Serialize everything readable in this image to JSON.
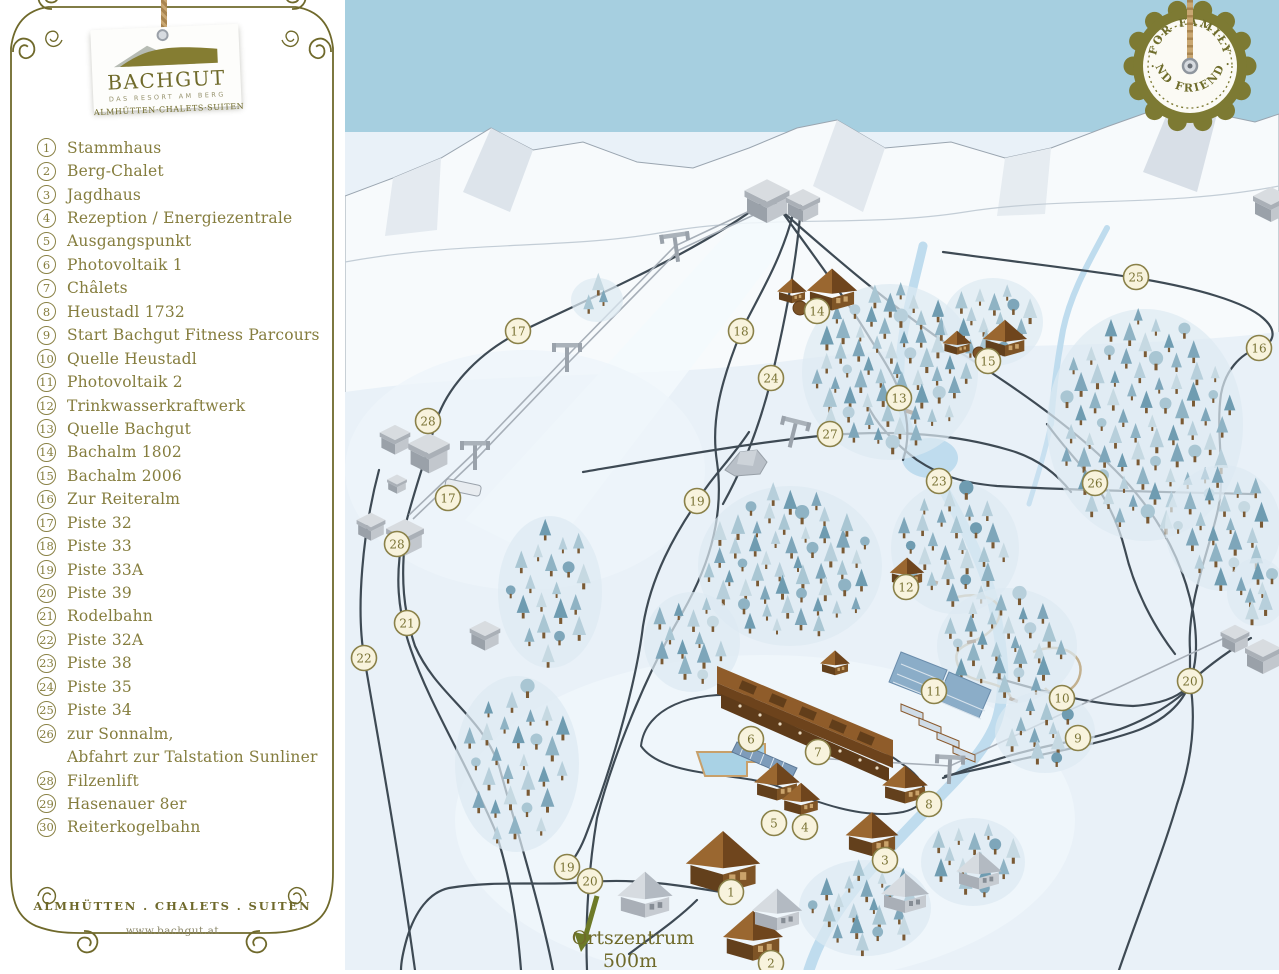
{
  "sidebar": {
    "logo": {
      "title": "BACHGUT",
      "subtitle": "DAS RESORT AM BERG",
      "tagline": "ALMHÜTTEN·CHALETS·SUITEN"
    },
    "legend": [
      {
        "num": "1",
        "label": "Stammhaus"
      },
      {
        "num": "2",
        "label": "Berg-Chalet"
      },
      {
        "num": "3",
        "label": "Jagdhaus"
      },
      {
        "num": "4",
        "label": "Rezeption / Energiezentrale"
      },
      {
        "num": "5",
        "label": "Ausgangspunkt"
      },
      {
        "num": "6",
        "label": "Photovoltaik 1"
      },
      {
        "num": "7",
        "label": "Châlets"
      },
      {
        "num": "8",
        "label": "Heustadl 1732"
      },
      {
        "num": "9",
        "label": "Start Bachgut Fitness Parcours"
      },
      {
        "num": "10",
        "label": "Quelle Heustadl"
      },
      {
        "num": "11",
        "label": "Photovoltaik 2"
      },
      {
        "num": "12",
        "label": "Trinkwasserkraftwerk"
      },
      {
        "num": "13",
        "label": "Quelle Bachgut"
      },
      {
        "num": "14",
        "label": "Bachalm 1802"
      },
      {
        "num": "15",
        "label": "Bachalm 2006"
      },
      {
        "num": "16",
        "label": "Zur Reiteralm"
      },
      {
        "num": "17",
        "label": "Piste 32"
      },
      {
        "num": "18",
        "label": "Piste 33"
      },
      {
        "num": "19",
        "label": "Piste 33A"
      },
      {
        "num": "20",
        "label": "Piste 39"
      },
      {
        "num": "21",
        "label": "Rodelbahn"
      },
      {
        "num": "22",
        "label": "Piste 32A"
      },
      {
        "num": "23",
        "label": "Piste 38"
      },
      {
        "num": "24",
        "label": "Piste 35"
      },
      {
        "num": "25",
        "label": "Piste 34"
      },
      {
        "num": "26",
        "label": "zur Sonnalm,",
        "label2": "Abfahrt zur Talstation Sunliner"
      },
      {
        "num": "28",
        "label": "Filzenlift"
      },
      {
        "num": "29",
        "label": "Hasenauer 8er"
      },
      {
        "num": "30",
        "label": "Reiterkogelbahn"
      }
    ],
    "footer": {
      "line1": "ALMHÜTTEN . CHALETS . SUITEN",
      "line2": "www.bachgut.at"
    }
  },
  "map": {
    "badge": {
      "top": "· FOR  FAMILY ·",
      "bottom": "· AND FRIENDS ·"
    },
    "direction_label": {
      "line1": "Ortszentrum",
      "line2": "500m"
    },
    "markers": [
      {
        "n": "17",
        "x": 173,
        "y": 331
      },
      {
        "n": "18",
        "x": 396,
        "y": 331
      },
      {
        "n": "14",
        "x": 472,
        "y": 311
      },
      {
        "n": "25",
        "x": 791,
        "y": 277
      },
      {
        "n": "16",
        "x": 914,
        "y": 348
      },
      {
        "n": "15",
        "x": 643,
        "y": 361
      },
      {
        "n": "24",
        "x": 426,
        "y": 378
      },
      {
        "n": "13",
        "x": 554,
        "y": 398
      },
      {
        "n": "28",
        "x": 83,
        "y": 421
      },
      {
        "n": "27",
        "x": 485,
        "y": 434
      },
      {
        "n": "23",
        "x": 594,
        "y": 481
      },
      {
        "n": "26",
        "x": 750,
        "y": 483
      },
      {
        "n": "19",
        "x": 352,
        "y": 501
      },
      {
        "n": "17",
        "x": 103,
        "y": 498
      },
      {
        "n": "28",
        "x": 52,
        "y": 544
      },
      {
        "n": "12",
        "x": 561,
        "y": 587
      },
      {
        "n": "21",
        "x": 62,
        "y": 623
      },
      {
        "n": "22",
        "x": 19,
        "y": 658
      },
      {
        "n": "20",
        "x": 845,
        "y": 681
      },
      {
        "n": "11",
        "x": 589,
        "y": 691
      },
      {
        "n": "10",
        "x": 717,
        "y": 698
      },
      {
        "n": "9",
        "x": 733,
        "y": 738
      },
      {
        "n": "6",
        "x": 406,
        "y": 739
      },
      {
        "n": "7",
        "x": 473,
        "y": 752
      },
      {
        "n": "8",
        "x": 584,
        "y": 804
      },
      {
        "n": "5",
        "x": 429,
        "y": 823
      },
      {
        "n": "4",
        "x": 460,
        "y": 827
      },
      {
        "n": "3",
        "x": 540,
        "y": 860
      },
      {
        "n": "19",
        "x": 222,
        "y": 867
      },
      {
        "n": "20",
        "x": 245,
        "y": 881
      },
      {
        "n": "1",
        "x": 386,
        "y": 892
      },
      {
        "n": "2",
        "x": 426,
        "y": 963
      }
    ],
    "tree_clusters": [
      {
        "x": 545,
        "y": 372,
        "rx": 78,
        "ry": 80,
        "n": 58
      },
      {
        "x": 648,
        "y": 322,
        "rx": 40,
        "ry": 36,
        "n": 15
      },
      {
        "x": 800,
        "y": 425,
        "rx": 88,
        "ry": 108,
        "n": 72
      },
      {
        "x": 878,
        "y": 528,
        "rx": 48,
        "ry": 55,
        "n": 20
      },
      {
        "x": 445,
        "y": 566,
        "rx": 82,
        "ry": 72,
        "n": 52
      },
      {
        "x": 610,
        "y": 548,
        "rx": 54,
        "ry": 58,
        "n": 26
      },
      {
        "x": 662,
        "y": 646,
        "rx": 60,
        "ry": 50,
        "n": 26
      },
      {
        "x": 205,
        "y": 592,
        "rx": 42,
        "ry": 68,
        "n": 20
      },
      {
        "x": 172,
        "y": 764,
        "rx": 52,
        "ry": 80,
        "n": 28
      },
      {
        "x": 347,
        "y": 642,
        "rx": 38,
        "ry": 42,
        "n": 13
      },
      {
        "x": 520,
        "y": 908,
        "rx": 56,
        "ry": 40,
        "n": 20
      },
      {
        "x": 700,
        "y": 732,
        "rx": 40,
        "ry": 33,
        "n": 12
      },
      {
        "x": 252,
        "y": 300,
        "rx": 16,
        "ry": 14,
        "n": 3
      },
      {
        "x": 628,
        "y": 862,
        "rx": 42,
        "ry": 36,
        "n": 14
      },
      {
        "x": 912,
        "y": 592,
        "rx": 20,
        "ry": 26,
        "n": 7
      }
    ],
    "colors": {
      "accent_olive": "#6f692b",
      "legend_text": "#857d3e",
      "marker_fill": "#f8f3dd",
      "marker_stroke": "#8a8149",
      "piste_line": "#3e4a54",
      "sky": "#a6cfe0",
      "snow": "#e9f1f8",
      "stream": "#bfdcee",
      "chalet_brown": "#8a5a2a",
      "tree_palette": [
        "#7ea6ba",
        "#a9c6d3",
        "#c6d9e2",
        "#8fb3c4",
        "#6f9cb1",
        "#b7cfdb"
      ]
    }
  }
}
